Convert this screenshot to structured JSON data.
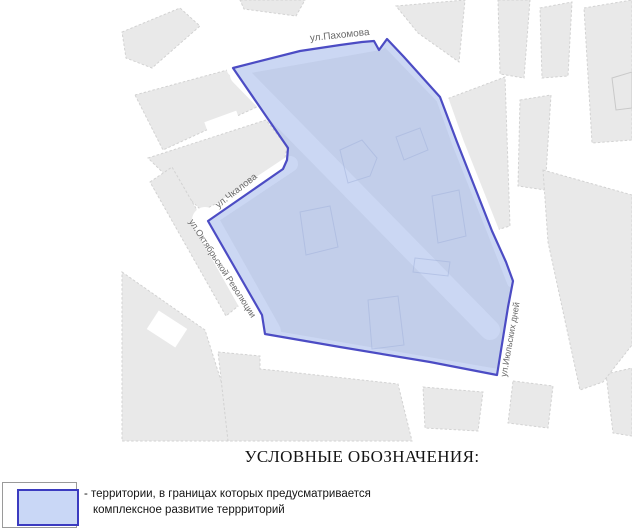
{
  "map": {
    "street_labels": [
      {
        "name": "pakhomova",
        "text": "ул.Пахомова"
      },
      {
        "name": "chkalova",
        "text": "ул.Чкалова"
      },
      {
        "name": "oktyabrskoy-revolyutsii",
        "text": "ул.Октябрьской Революции"
      },
      {
        "name": "iyulskikh-dney",
        "text": "ул.Июльских дней"
      }
    ],
    "colors": {
      "territory_fill": "#a9bdeb",
      "territory_stroke": "#4c4cc4",
      "block_fill": "#e9e9e9",
      "street_label": "#6a6a6a"
    }
  },
  "legend": {
    "title": "УСЛОВНЫЕ ОБОЗНАЧЕНИЯ:",
    "item": {
      "line1": "- территории, в границах которых предусматривается",
      "line2": "комплексное развитие террриторий",
      "swatch_fill": "#c9d7f6",
      "swatch_border": "#3b3bc0"
    }
  }
}
